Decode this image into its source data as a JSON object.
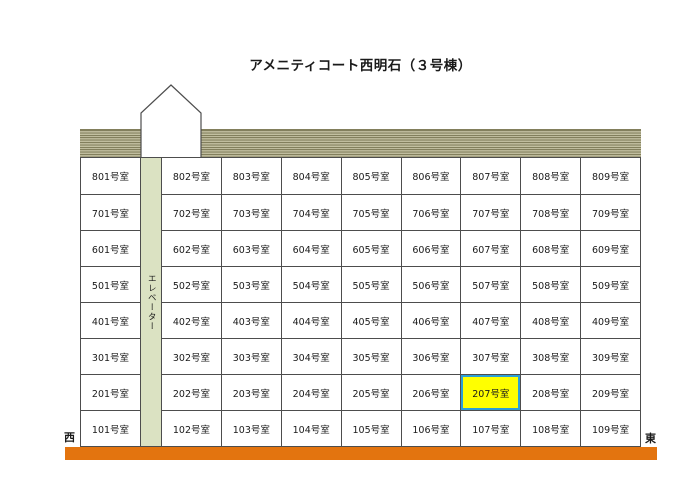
{
  "title": "アメニティコート西明石（３号棟）",
  "building": {
    "elevator_label": "エレベーター",
    "west_label": "西",
    "east_label": "東",
    "highlighted_room": "207号室",
    "floors": [
      {
        "rooms": [
          "801号室",
          "802号室",
          "803号室",
          "804号室",
          "805号室",
          "806号室",
          "807号室",
          "808号室",
          "809号室"
        ]
      },
      {
        "rooms": [
          "701号室",
          "702号室",
          "703号室",
          "704号室",
          "705号室",
          "706号室",
          "707号室",
          "708号室",
          "709号室"
        ]
      },
      {
        "rooms": [
          "601号室",
          "602号室",
          "603号室",
          "604号室",
          "605号室",
          "606号室",
          "607号室",
          "608号室",
          "609号室"
        ]
      },
      {
        "rooms": [
          "501号室",
          "502号室",
          "503号室",
          "504号室",
          "505号室",
          "506号室",
          "507号室",
          "508号室",
          "509号室"
        ]
      },
      {
        "rooms": [
          "401号室",
          "402号室",
          "403号室",
          "404号室",
          "405号室",
          "406号室",
          "407号室",
          "408号室",
          "409号室"
        ]
      },
      {
        "rooms": [
          "301号室",
          "302号室",
          "303号室",
          "304号室",
          "305号室",
          "306号室",
          "307号室",
          "308号室",
          "309号室"
        ]
      },
      {
        "rooms": [
          "201号室",
          "202号室",
          "203号室",
          "204号室",
          "205号室",
          "206号室",
          "207号室",
          "208号室",
          "209号室"
        ]
      },
      {
        "rooms": [
          "101号室",
          "102号室",
          "103号室",
          "104号室",
          "105号室",
          "106号室",
          "107号室",
          "108号室",
          "109号室"
        ]
      }
    ]
  },
  "colors": {
    "grid_line": "#4d4d4d",
    "highlight_fill": "#ffff00",
    "highlight_border": "#2d9fd6",
    "elevator_fill": "#dbe2c2",
    "roof_stripe_dark": "#827f5c",
    "roof_stripe_mid": "#b6b394",
    "roof_stripe_light": "#c6c3a4",
    "ground_bar": "#e3740f"
  }
}
